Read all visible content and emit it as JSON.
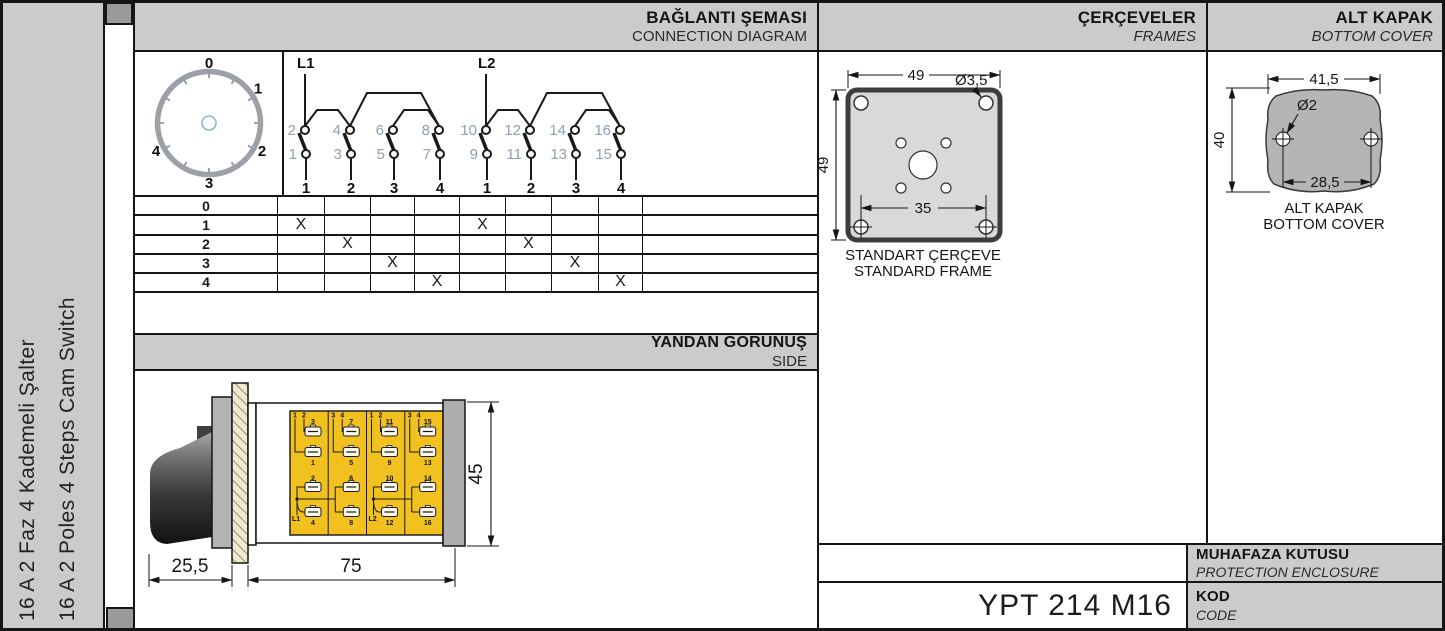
{
  "sidebar": {
    "title_tr": "16 A 2 Faz 4 Kademeli Şalter",
    "title_en": "16 A 2 Poles 4 Steps Cam Switch"
  },
  "headers": {
    "connection": {
      "tr": "BAĞLANTI ŞEMASI",
      "en": "CONNECTION DIAGRAM"
    },
    "frames": {
      "tr": "ÇERÇEVELER",
      "en": "FRAMES"
    },
    "bottom_cover": {
      "tr": "ALT KAPAK",
      "en": "BOTTOM COVER"
    },
    "side": {
      "tr": "YANDAN GÖRÜNÜŞ",
      "en": "SIDE"
    },
    "protection": {
      "tr": "MUHAFAZA KUTUSU",
      "en": "PROTECTION ENCLOSURE"
    },
    "code": {
      "tr": "KOD",
      "en": "CODE"
    }
  },
  "product_code": "YPT 214 M16",
  "dial": {
    "positions": [
      "0",
      "1",
      "2",
      "3",
      "4"
    ]
  },
  "connection_diagram": {
    "groups": [
      {
        "label": "L1",
        "contacts": [
          {
            "top": "2",
            "bottom": "1",
            "terminal": "1"
          },
          {
            "top": "4",
            "bottom": "3",
            "terminal": "2"
          },
          {
            "top": "6",
            "bottom": "5",
            "terminal": "3"
          },
          {
            "top": "8",
            "bottom": "7",
            "terminal": "4"
          }
        ]
      },
      {
        "label": "L2",
        "contacts": [
          {
            "top": "10",
            "bottom": "9",
            "terminal": "1"
          },
          {
            "top": "12",
            "bottom": "11",
            "terminal": "2"
          },
          {
            "top": "14",
            "bottom": "13",
            "terminal": "3"
          },
          {
            "top": "16",
            "bottom": "15",
            "terminal": "4"
          }
        ]
      }
    ]
  },
  "switch_table": {
    "mark": "X",
    "rows": [
      {
        "label": "0",
        "marks": []
      },
      {
        "label": "1",
        "marks": [
          1,
          5
        ]
      },
      {
        "label": "2",
        "marks": [
          2,
          6
        ]
      },
      {
        "label": "3",
        "marks": [
          3,
          7
        ]
      },
      {
        "label": "4",
        "marks": [
          4,
          8
        ]
      }
    ]
  },
  "side_view": {
    "dim_front": "25,5",
    "dim_body": "75",
    "dim_height": "45",
    "modules": [
      {
        "poles": [
          "1",
          "2"
        ],
        "upper_top": "3",
        "upper_bottom": "1",
        "lower_top": "2",
        "lower_bottom": "4",
        "line": "L1"
      },
      {
        "poles": [
          "3",
          "4"
        ],
        "upper_top": "7",
        "upper_bottom": "5",
        "lower_top": "6",
        "lower_bottom": "8",
        "line": ""
      },
      {
        "poles": [
          "1",
          "2"
        ],
        "upper_top": "11",
        "upper_bottom": "9",
        "lower_top": "10",
        "lower_bottom": "12",
        "line": "L2"
      },
      {
        "poles": [
          "3",
          "4"
        ],
        "upper_top": "15",
        "upper_bottom": "13",
        "lower_top": "14",
        "lower_bottom": "16",
        "line": ""
      }
    ]
  },
  "frame": {
    "dim_width": "49",
    "dim_height": "49",
    "hole_dia": "Ø3,5",
    "dim_inner": "35",
    "caption_tr": "STANDART ÇERÇEVE",
    "caption_en": "STANDARD FRAME"
  },
  "cover": {
    "dim_width": "41,5",
    "dim_height": "40",
    "hole_dia": "Ø2",
    "dim_holes": "28,5",
    "caption_tr": "ALT KAPAK",
    "caption_en": "BOTTOM COVER"
  },
  "colors": {
    "panel_gray": "#cbcbcb",
    "tab_gray": "#9a9a9a",
    "module_yellow": "#f1c11f",
    "number_gray": "#8fa0b2",
    "line": "#151515"
  }
}
